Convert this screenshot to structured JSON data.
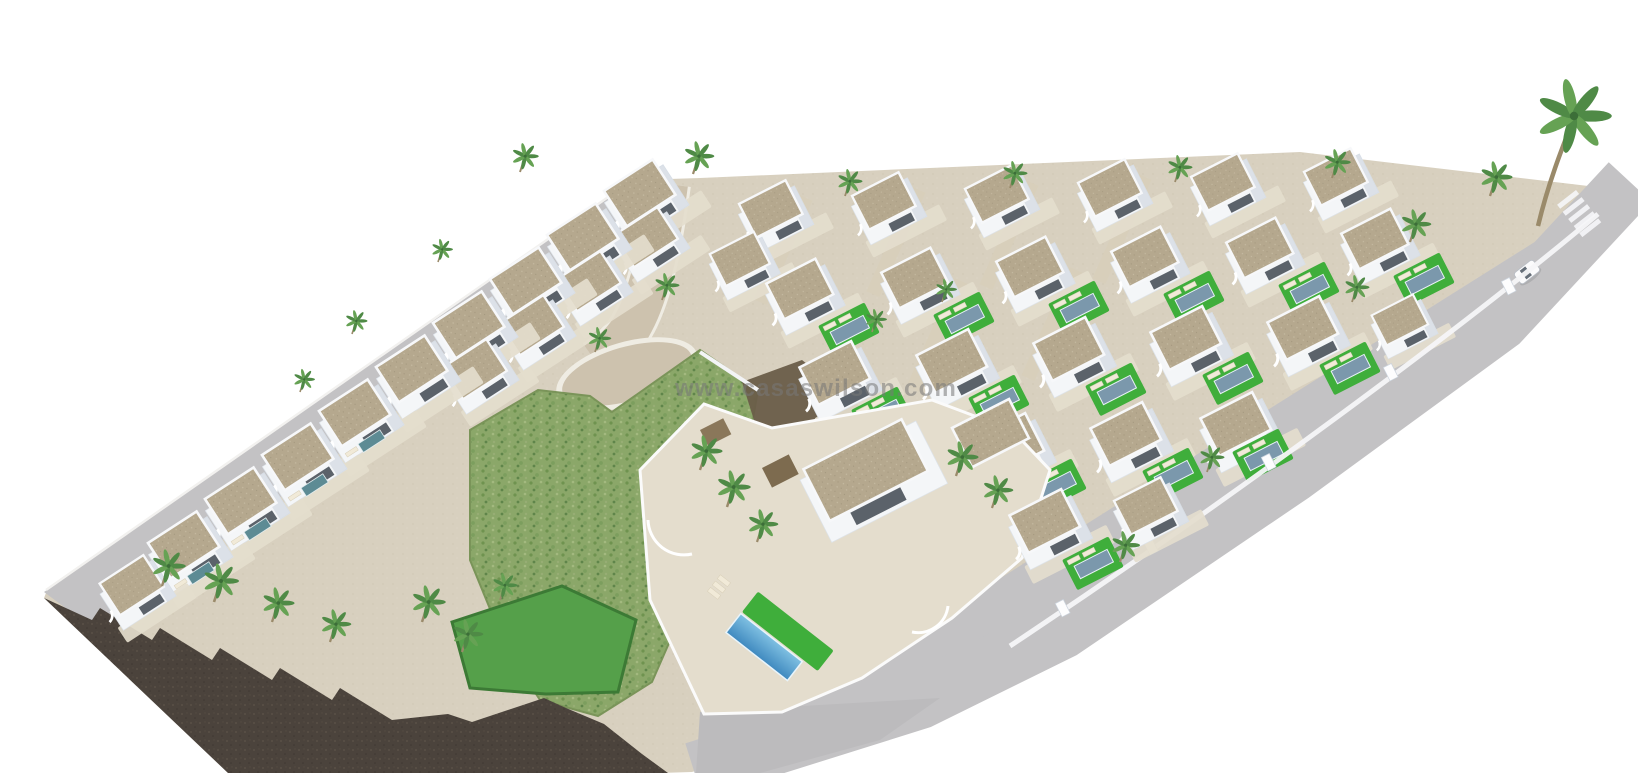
{
  "watermark": {
    "text": "www.casaswilson.com"
  },
  "palette": {
    "background": "#ffffff",
    "road_gray": "#c3c2c4",
    "road_tan": "#cdc2ae",
    "sand": "#d8d0bf",
    "sand_light": "#e4ddcd",
    "villa_white": "#f4f6f8",
    "villa_shadow": "#ccd4de",
    "opening_dark": "#39414b",
    "roof_tan": "#b5a88e",
    "roof_speck": "#c6bba2",
    "lawn_green": "#3fae3b",
    "scrub_green": "#8ba769",
    "scrub_dark": "#6f934f",
    "rock_dark": "#4b433c",
    "rock_light": "#5d544a",
    "pool_blue": "#7b98ac",
    "pool_teal": "#5d8b94",
    "pool_bright_top": "#7fc0e2",
    "pool_bright_bottom": "#3f89bf",
    "palm_green": "#4f8a46",
    "palm_light": "#66a254",
    "trunk_brown": "#9a8a6a",
    "watermark_gray": "#787878"
  }
}
